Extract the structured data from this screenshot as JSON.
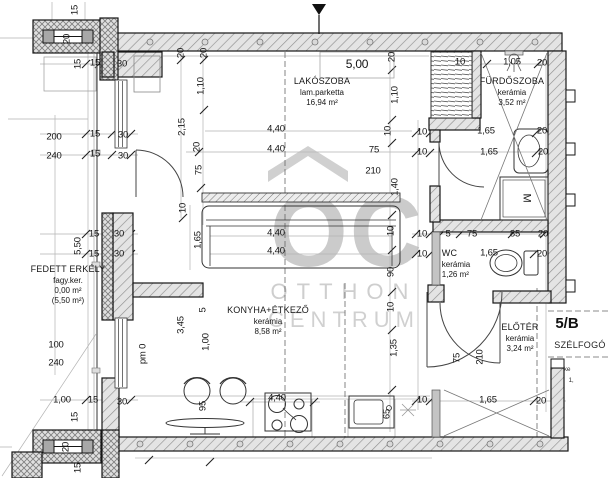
{
  "watermark": {
    "logo": "OC",
    "line1": "OTTHON",
    "line2": "CENTRUM"
  },
  "unit": {
    "label": "5/B",
    "vestibule": "SZÉLFOGÓ"
  },
  "colors": {
    "wall_fill": "#e4e4e4",
    "hatch": "#909090",
    "line": "#161616",
    "dim_text": "#141414",
    "watermark": "#c9c9c9",
    "partition": "#c4c4c4"
  },
  "rooms": [
    {
      "name": "LAKÓSZOBA",
      "floor": "lam.parketta",
      "area": "16,94 m²"
    },
    {
      "name": "FÜRDŐSZOBA",
      "floor": "kerámia",
      "area": "3,52 m²"
    },
    {
      "name": "WC",
      "floor": "kerámia",
      "area": "1,26 m²"
    },
    {
      "name": "KONYHA+ÉTKEZŐ",
      "floor": "kerámia",
      "area": "8,58 m²"
    },
    {
      "name": "ELŐTÉR",
      "floor": "kerámia",
      "area": "3,24 m²"
    },
    {
      "name": "FEDETT ERKÉLY",
      "floor": "fagy.ker.",
      "area": "0,00 m²",
      "area2": "(5,50 m²)"
    }
  ],
  "dimensions": [
    {
      "t": "15",
      "x": 75,
      "y": 10,
      "r": -90
    },
    {
      "t": "20",
      "x": 67,
      "y": 39,
      "r": -90
    },
    {
      "t": "15",
      "x": 78,
      "y": 64,
      "r": -90
    },
    {
      "t": "15",
      "x": 95,
      "y": 63
    },
    {
      "t": "30",
      "x": 122,
      "y": 64
    },
    {
      "t": "20",
      "x": 181,
      "y": 53,
      "r": -90
    },
    {
      "t": "20",
      "x": 204,
      "y": 53,
      "r": -90
    },
    {
      "t": "1,10",
      "x": 201,
      "y": 86,
      "r": -90
    },
    {
      "t": "2,15",
      "x": 182,
      "y": 127,
      "r": -90
    },
    {
      "t": "20",
      "x": 197,
      "y": 147,
      "r": -90
    },
    {
      "t": "75",
      "x": 199,
      "y": 170,
      "r": -90
    },
    {
      "t": "10",
      "x": 183,
      "y": 208,
      "r": -90
    },
    {
      "t": "5,00",
      "x": 357,
      "y": 64,
      "f": 12
    },
    {
      "t": "20",
      "x": 392,
      "y": 57,
      "r": -90
    },
    {
      "t": "1,10",
      "x": 395,
      "y": 95,
      "r": -90
    },
    {
      "t": "10",
      "x": 388,
      "y": 131,
      "r": -90
    },
    {
      "t": "1,40",
      "x": 395,
      "y": 187,
      "r": -90
    },
    {
      "t": "10",
      "x": 391,
      "y": 231,
      "r": -90
    },
    {
      "t": "90",
      "x": 391,
      "y": 272,
      "r": -90
    },
    {
      "t": "10",
      "x": 391,
      "y": 307,
      "r": -90
    },
    {
      "t": "1,35",
      "x": 394,
      "y": 348,
      "r": -90
    },
    {
      "t": "10",
      "x": 460,
      "y": 62
    },
    {
      "t": "1,05",
      "x": 512,
      "y": 62
    },
    {
      "t": "20",
      "x": 542,
      "y": 63
    },
    {
      "t": "1,65",
      "x": 486,
      "y": 131
    },
    {
      "t": "20",
      "x": 542,
      "y": 131
    },
    {
      "t": "10",
      "x": 422,
      "y": 132
    },
    {
      "t": "10",
      "x": 422,
      "y": 152
    },
    {
      "t": "1,65",
      "x": 489,
      "y": 152
    },
    {
      "t": "20",
      "x": 543,
      "y": 152
    },
    {
      "t": "200",
      "x": 54,
      "y": 137
    },
    {
      "t": "240",
      "x": 54,
      "y": 156
    },
    {
      "t": "15",
      "x": 95,
      "y": 134
    },
    {
      "t": "30",
      "x": 123,
      "y": 135
    },
    {
      "t": "15",
      "x": 95,
      "y": 154
    },
    {
      "t": "30",
      "x": 123,
      "y": 156
    },
    {
      "t": "4,40",
      "x": 276,
      "y": 129
    },
    {
      "t": "4,40",
      "x": 276,
      "y": 149
    },
    {
      "t": "75",
      "x": 374,
      "y": 150
    },
    {
      "t": "210",
      "x": 373,
      "y": 171
    },
    {
      "t": "1,65",
      "x": 198,
      "y": 240,
      "r": -90
    },
    {
      "t": "4,40",
      "x": 276,
      "y": 233
    },
    {
      "t": "4,40",
      "x": 276,
      "y": 251
    },
    {
      "t": "5,50",
      "x": 78,
      "y": 246,
      "r": -90
    },
    {
      "t": "15",
      "x": 94,
      "y": 234
    },
    {
      "t": "30",
      "x": 119,
      "y": 234
    },
    {
      "t": "15",
      "x": 94,
      "y": 254
    },
    {
      "t": "30",
      "x": 119,
      "y": 254
    },
    {
      "t": "10",
      "x": 422,
      "y": 234
    },
    {
      "t": "5",
      "x": 448,
      "y": 234
    },
    {
      "t": "75",
      "x": 472,
      "y": 234
    },
    {
      "t": "85",
      "x": 515,
      "y": 234
    },
    {
      "t": "20",
      "x": 543,
      "y": 234
    },
    {
      "t": "10",
      "x": 422,
      "y": 254
    },
    {
      "t": "1,65",
      "x": 489,
      "y": 253
    },
    {
      "t": "20",
      "x": 542,
      "y": 254
    },
    {
      "t": "100",
      "x": 56,
      "y": 345
    },
    {
      "t": "240",
      "x": 56,
      "y": 363
    },
    {
      "t": "3,45",
      "x": 181,
      "y": 325,
      "r": -90
    },
    {
      "t": "5",
      "x": 203,
      "y": 310,
      "r": -90
    },
    {
      "t": "1,00",
      "x": 206,
      "y": 342,
      "r": -90
    },
    {
      "t": "pm 0",
      "x": 143,
      "y": 354,
      "r": -90
    },
    {
      "t": "75",
      "x": 457,
      "y": 358,
      "r": -90
    },
    {
      "t": "210",
      "x": 480,
      "y": 357,
      "r": -90
    },
    {
      "t": "95",
      "x": 203,
      "y": 406,
      "r": -90
    },
    {
      "t": "65",
      "x": 387,
      "y": 414,
      "r": -90
    },
    {
      "t": "4,40",
      "x": 277,
      "y": 398
    },
    {
      "t": "10",
      "x": 422,
      "y": 400
    },
    {
      "t": "1,65",
      "x": 488,
      "y": 400
    },
    {
      "t": "20",
      "x": 541,
      "y": 401
    },
    {
      "t": "1,00",
      "x": 62,
      "y": 400
    },
    {
      "t": "15",
      "x": 93,
      "y": 400
    },
    {
      "t": "30",
      "x": 122,
      "y": 402
    },
    {
      "t": "15",
      "x": 75,
      "y": 417,
      "r": -90
    },
    {
      "t": "20",
      "x": 66,
      "y": 447,
      "r": -90
    },
    {
      "t": "15",
      "x": 78,
      "y": 468,
      "r": -90
    },
    {
      "t": "M",
      "x": 526,
      "y": 198,
      "r": 90,
      "f": 11
    },
    {
      "t": "ke",
      "x": 567,
      "y": 370,
      "s": "sm"
    },
    {
      "t": "1,",
      "x": 571,
      "y": 381,
      "s": "sm"
    }
  ]
}
